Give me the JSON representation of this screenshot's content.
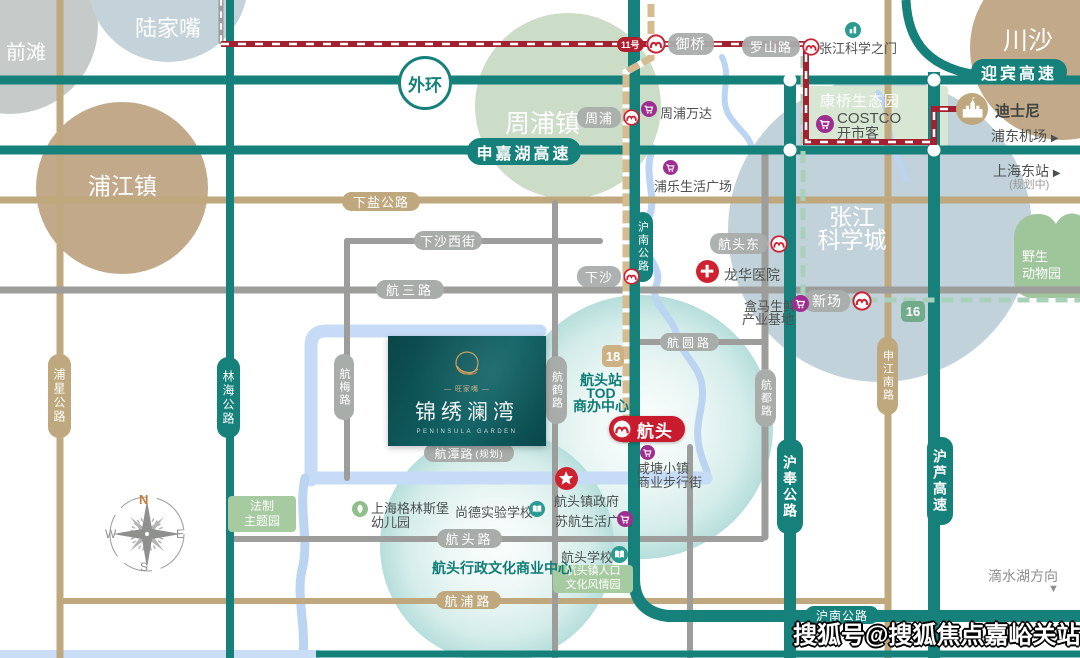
{
  "districts": {
    "qiantan": "前滩",
    "lujiazui": "陆家嘴",
    "pujiang": "浦江镇",
    "zhoupu": "周浦镇",
    "chuansha": "川沙",
    "zhangjiang_l1": "张江",
    "zhangjiang_l2": "科学城",
    "wildlife_l1": "野生",
    "wildlife_l2": "动物园",
    "kangqiao": "康桥生态园"
  },
  "highways": {
    "waihuan": "外环",
    "shenjiahu": "申嘉湖高速",
    "yingbin": "迎宾高速",
    "hunan_v": "沪南公路",
    "hunan_b": "沪南公路",
    "hufeng": "沪奉公路",
    "hulu": "沪芦高速"
  },
  "roads": {
    "xiayan": "下盐公路",
    "xiashaxijie": "下沙西街",
    "hangsan": "航三路",
    "hangyuan": "航圆路",
    "hangtan": "航潭路",
    "hangtan_note": "(规划)",
    "hangtoulu": "航头路",
    "hangpu": "航浦路",
    "puxing": "浦星公路",
    "linhai": "林海公路",
    "hangmei": "航梅路",
    "hanghe": "航鹤路",
    "hanghe_note": "规划",
    "hangdu": "航都路",
    "shenjiangnan": "申江南路"
  },
  "stations": {
    "yuqiao": "御桥",
    "luoshanlu": "罗山路",
    "zhoupu": "周浦",
    "xiasha": "下沙",
    "hangtoudong": "航头东",
    "xinchang": "新场",
    "hangtou": "航头"
  },
  "metro_badges": {
    "line11": "11号",
    "line16": "16",
    "line18": "18"
  },
  "pois": {
    "zhangjiang_gate": "张江科学之门",
    "wanda": "周浦万达",
    "pule": "浦乐生活广场",
    "costco_l1": "COSTCO",
    "costco_l2": "开市客",
    "longhua": "龙华医院",
    "hema_l1": "盒马生鲜",
    "hema_l2": "产业基地",
    "disney": "迪士尼",
    "airport": "浦东机场",
    "airport_arrow": "▶",
    "east_station": "上海东站",
    "east_station_note": "(规划中)",
    "east_arrow": "▶",
    "tod_l1": "航头站",
    "tod_l2": "TOD",
    "tod_l3": "商办中心",
    "xiantang_l1": "咸塘小镇",
    "xiantang_l2": "商业步行街",
    "gov": "航头镇政府",
    "suhang": "苏航生活广场",
    "school_hangtou": "航头学校",
    "shangde": "尚德实验学校",
    "greensburg_l1": "上海格林斯堡",
    "greensburg_l2": "幼儿园",
    "fazhi_l1": "法制",
    "fazhi_l2": "主题园",
    "renkou_l1": "航头镇人口",
    "renkou_l2": "文化风情园",
    "admin_center": "航头行政文化商业中心",
    "dishuihu": "滴水湖方向",
    "dishuihu_arrow": "▼"
  },
  "project": {
    "brand": "— 旺家嘴 —",
    "name": "锦绣澜湾",
    "name_en": "PENINSULA GARDEN"
  },
  "compass": {
    "n": "N",
    "e": "E",
    "s": "S",
    "w": "W"
  },
  "watermark": "搜狐号@搜狐焦点嘉峪关站",
  "colors": {
    "teal_road": "#16807b",
    "tan_road": "#c0a87e",
    "gray_road": "#9d9d9b",
    "metro11_red": "#a32030",
    "line16_green": "#a8d1ba",
    "line18_tan": "#d5bb8f",
    "river_blue": "#bad4f2",
    "poi_purple": "#9e2f91",
    "icon_red": "#cf2231",
    "park_green": "#a6cba0",
    "accent_teal_text": "#0e7c76"
  }
}
